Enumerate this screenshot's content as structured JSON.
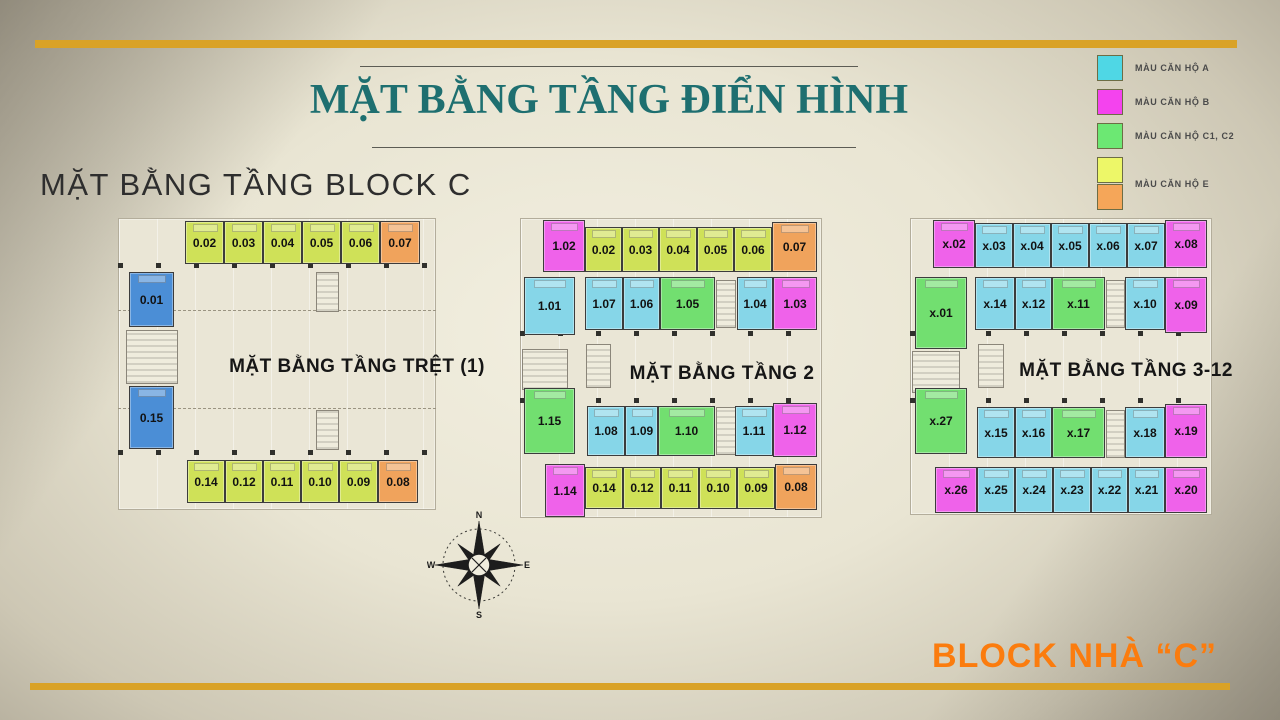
{
  "slide": {
    "title": "MẶT BẰNG TẦNG ĐIỂN HÌNH",
    "subtitle": "MẶT BẰNG TẦNG BLOCK C",
    "footer": "BLOCK NHÀ “C”"
  },
  "compass": {
    "n": "N",
    "e": "E",
    "s": "S",
    "w": "W"
  },
  "legend": {
    "items": [
      {
        "label": "MÀU CĂN HỘ A",
        "colors": [
          "#4fd7e5"
        ]
      },
      {
        "label": "MÀU CĂN HỘ B",
        "colors": [
          "#f443ee"
        ]
      },
      {
        "label": "MÀU CĂN HỘ C1, C2",
        "colors": [
          "#6ce873"
        ]
      },
      {
        "label": "MÀU CĂN HỘ E",
        "colors": [
          "#edf768",
          "#f5a659"
        ]
      }
    ]
  },
  "unit_colors": {
    "A": "#86d6e8",
    "B": "#ef62ea",
    "C": "#72df70",
    "E": "#cfe158",
    "O": "#f0a35c",
    "S": "#4b8ed6"
  },
  "plans": [
    {
      "id": "tret",
      "label": "MẶT BẰNG TẦNG TRỆT (1)",
      "label_cx": 357,
      "label_cy": 367,
      "area": {
        "x": 118,
        "y": 218,
        "w": 318,
        "h": 292
      },
      "structures": [
        {
          "kind": "ticks",
          "x": 118,
          "y": 263,
          "w": 318,
          "h": 5
        },
        {
          "kind": "ticks",
          "x": 118,
          "y": 450,
          "w": 318,
          "h": 5
        },
        {
          "kind": "dash",
          "x": 118,
          "y": 310,
          "w": 318,
          "h": 1
        },
        {
          "kind": "dash",
          "x": 118,
          "y": 408,
          "w": 318,
          "h": 1
        },
        {
          "kind": "core",
          "x": 126,
          "y": 330,
          "w": 52,
          "h": 54
        },
        {
          "kind": "core",
          "x": 316,
          "y": 272,
          "w": 23,
          "h": 40
        },
        {
          "kind": "core",
          "x": 316,
          "y": 410,
          "w": 23,
          "h": 40
        }
      ],
      "units": [
        {
          "id": "0.02",
          "t": "E",
          "x": 185,
          "y": 221,
          "w": 39,
          "h": 43
        },
        {
          "id": "0.03",
          "t": "E",
          "x": 224,
          "y": 221,
          "w": 39,
          "h": 43
        },
        {
          "id": "0.04",
          "t": "E",
          "x": 263,
          "y": 221,
          "w": 39,
          "h": 43
        },
        {
          "id": "0.05",
          "t": "E",
          "x": 302,
          "y": 221,
          "w": 39,
          "h": 43
        },
        {
          "id": "0.06",
          "t": "E",
          "x": 341,
          "y": 221,
          "w": 39,
          "h": 43
        },
        {
          "id": "0.07",
          "t": "O",
          "x": 380,
          "y": 221,
          "w": 40,
          "h": 43
        },
        {
          "id": "0.01",
          "t": "S",
          "x": 129,
          "y": 272,
          "w": 45,
          "h": 55
        },
        {
          "id": "0.15",
          "t": "S",
          "x": 129,
          "y": 386,
          "w": 45,
          "h": 63
        },
        {
          "id": "0.14",
          "t": "E",
          "x": 187,
          "y": 460,
          "w": 38,
          "h": 43
        },
        {
          "id": "0.12",
          "t": "E",
          "x": 225,
          "y": 460,
          "w": 38,
          "h": 43
        },
        {
          "id": "0.11",
          "t": "E",
          "x": 263,
          "y": 460,
          "w": 38,
          "h": 43
        },
        {
          "id": "0.10",
          "t": "E",
          "x": 301,
          "y": 460,
          "w": 38,
          "h": 43
        },
        {
          "id": "0.09",
          "t": "E",
          "x": 339,
          "y": 460,
          "w": 39,
          "h": 43
        },
        {
          "id": "0.08",
          "t": "O",
          "x": 378,
          "y": 460,
          "w": 40,
          "h": 43
        }
      ]
    },
    {
      "id": "tang2",
      "label": "MẶT BẰNG TẦNG 2",
      "label_cx": 722,
      "label_cy": 374,
      "area": {
        "x": 520,
        "y": 218,
        "w": 302,
        "h": 300
      },
      "structures": [
        {
          "kind": "ticks",
          "x": 520,
          "y": 331,
          "w": 300,
          "h": 5
        },
        {
          "kind": "ticks",
          "x": 520,
          "y": 398,
          "w": 300,
          "h": 5
        },
        {
          "kind": "core",
          "x": 716,
          "y": 280,
          "w": 20,
          "h": 48
        },
        {
          "kind": "core",
          "x": 716,
          "y": 407,
          "w": 20,
          "h": 48
        },
        {
          "kind": "core",
          "x": 522,
          "y": 349,
          "w": 46,
          "h": 41
        },
        {
          "kind": "core",
          "x": 586,
          "y": 344,
          "w": 25,
          "h": 44
        }
      ],
      "units": [
        {
          "id": "1.02",
          "t": "B",
          "x": 543,
          "y": 220,
          "w": 42,
          "h": 52
        },
        {
          "id": "0.02",
          "t": "E",
          "x": 585,
          "y": 227,
          "w": 37,
          "h": 45
        },
        {
          "id": "0.03",
          "t": "E",
          "x": 622,
          "y": 227,
          "w": 37,
          "h": 45
        },
        {
          "id": "0.04",
          "t": "E",
          "x": 659,
          "y": 227,
          "w": 38,
          "h": 45
        },
        {
          "id": "0.05",
          "t": "E",
          "x": 697,
          "y": 227,
          "w": 37,
          "h": 45
        },
        {
          "id": "0.06",
          "t": "E",
          "x": 734,
          "y": 227,
          "w": 38,
          "h": 45
        },
        {
          "id": "0.07",
          "t": "O",
          "x": 772,
          "y": 222,
          "w": 45,
          "h": 50
        },
        {
          "id": "1.01",
          "t": "A",
          "x": 524,
          "y": 277,
          "w": 51,
          "h": 58
        },
        {
          "id": "1.07",
          "t": "A",
          "x": 585,
          "y": 277,
          "w": 38,
          "h": 53
        },
        {
          "id": "1.06",
          "t": "A",
          "x": 623,
          "y": 277,
          "w": 37,
          "h": 53
        },
        {
          "id": "1.05",
          "t": "C",
          "x": 660,
          "y": 277,
          "w": 55,
          "h": 53
        },
        {
          "id": "1.04",
          "t": "A",
          "x": 737,
          "y": 277,
          "w": 36,
          "h": 53
        },
        {
          "id": "1.03",
          "t": "B",
          "x": 773,
          "y": 277,
          "w": 44,
          "h": 53
        },
        {
          "id": "1.15",
          "t": "C",
          "x": 524,
          "y": 388,
          "w": 51,
          "h": 66
        },
        {
          "id": "1.08",
          "t": "A",
          "x": 587,
          "y": 406,
          "w": 38,
          "h": 50
        },
        {
          "id": "1.09",
          "t": "A",
          "x": 625,
          "y": 406,
          "w": 33,
          "h": 50
        },
        {
          "id": "1.10",
          "t": "C",
          "x": 658,
          "y": 406,
          "w": 57,
          "h": 50
        },
        {
          "id": "1.11",
          "t": "A",
          "x": 735,
          "y": 406,
          "w": 38,
          "h": 50
        },
        {
          "id": "1.12",
          "t": "B",
          "x": 773,
          "y": 403,
          "w": 44,
          "h": 54
        },
        {
          "id": "1.14",
          "t": "B",
          "x": 545,
          "y": 464,
          "w": 40,
          "h": 53
        },
        {
          "id": "0.14",
          "t": "E",
          "x": 585,
          "y": 467,
          "w": 38,
          "h": 42
        },
        {
          "id": "0.12",
          "t": "E",
          "x": 623,
          "y": 467,
          "w": 38,
          "h": 42
        },
        {
          "id": "0.11",
          "t": "E",
          "x": 661,
          "y": 467,
          "w": 38,
          "h": 42
        },
        {
          "id": "0.10",
          "t": "E",
          "x": 699,
          "y": 467,
          "w": 38,
          "h": 42
        },
        {
          "id": "0.09",
          "t": "E",
          "x": 737,
          "y": 467,
          "w": 38,
          "h": 42
        },
        {
          "id": "0.08",
          "t": "O",
          "x": 775,
          "y": 464,
          "w": 42,
          "h": 46
        }
      ]
    },
    {
      "id": "tang3-12",
      "label": "MẶT BẰNG TẦNG 3-12",
      "label_cx": 1126,
      "label_cy": 371,
      "area": {
        "x": 910,
        "y": 218,
        "w": 302,
        "h": 297
      },
      "structures": [
        {
          "kind": "ticks",
          "x": 910,
          "y": 331,
          "w": 300,
          "h": 5
        },
        {
          "kind": "ticks",
          "x": 910,
          "y": 398,
          "w": 300,
          "h": 5
        },
        {
          "kind": "core",
          "x": 1106,
          "y": 280,
          "w": 19,
          "h": 48
        },
        {
          "kind": "core",
          "x": 1106,
          "y": 410,
          "w": 19,
          "h": 48
        },
        {
          "kind": "core",
          "x": 912,
          "y": 351,
          "w": 48,
          "h": 42
        },
        {
          "kind": "core",
          "x": 978,
          "y": 344,
          "w": 26,
          "h": 44
        }
      ],
      "units": [
        {
          "id": "x.02",
          "t": "B",
          "x": 933,
          "y": 220,
          "w": 42,
          "h": 48
        },
        {
          "id": "x.03",
          "t": "A",
          "x": 975,
          "y": 223,
          "w": 38,
          "h": 45
        },
        {
          "id": "x.04",
          "t": "A",
          "x": 1013,
          "y": 223,
          "w": 38,
          "h": 45
        },
        {
          "id": "x.05",
          "t": "A",
          "x": 1051,
          "y": 223,
          "w": 38,
          "h": 45
        },
        {
          "id": "x.06",
          "t": "A",
          "x": 1089,
          "y": 223,
          "w": 38,
          "h": 45
        },
        {
          "id": "x.07",
          "t": "A",
          "x": 1127,
          "y": 223,
          "w": 38,
          "h": 45
        },
        {
          "id": "x.08",
          "t": "B",
          "x": 1165,
          "y": 220,
          "w": 42,
          "h": 48
        },
        {
          "id": "x.01",
          "t": "C",
          "x": 915,
          "y": 277,
          "w": 52,
          "h": 72
        },
        {
          "id": "x.14",
          "t": "A",
          "x": 975,
          "y": 277,
          "w": 40,
          "h": 53
        },
        {
          "id": "x.12",
          "t": "A",
          "x": 1015,
          "y": 277,
          "w": 37,
          "h": 53
        },
        {
          "id": "x.11",
          "t": "C",
          "x": 1052,
          "y": 277,
          "w": 53,
          "h": 53
        },
        {
          "id": "x.10",
          "t": "A",
          "x": 1125,
          "y": 277,
          "w": 40,
          "h": 53
        },
        {
          "id": "x.09",
          "t": "B",
          "x": 1165,
          "y": 277,
          "w": 42,
          "h": 56
        },
        {
          "id": "x.27",
          "t": "C",
          "x": 915,
          "y": 388,
          "w": 52,
          "h": 66
        },
        {
          "id": "x.15",
          "t": "A",
          "x": 977,
          "y": 407,
          "w": 38,
          "h": 51
        },
        {
          "id": "x.16",
          "t": "A",
          "x": 1015,
          "y": 407,
          "w": 37,
          "h": 51
        },
        {
          "id": "x.17",
          "t": "C",
          "x": 1052,
          "y": 407,
          "w": 53,
          "h": 51
        },
        {
          "id": "x.18",
          "t": "A",
          "x": 1125,
          "y": 407,
          "w": 40,
          "h": 51
        },
        {
          "id": "x.19",
          "t": "B",
          "x": 1165,
          "y": 404,
          "w": 42,
          "h": 54
        },
        {
          "id": "x.26",
          "t": "B",
          "x": 935,
          "y": 467,
          "w": 42,
          "h": 46
        },
        {
          "id": "x.25",
          "t": "A",
          "x": 977,
          "y": 467,
          "w": 38,
          "h": 46
        },
        {
          "id": "x.24",
          "t": "A",
          "x": 1015,
          "y": 467,
          "w": 38,
          "h": 46
        },
        {
          "id": "x.23",
          "t": "A",
          "x": 1053,
          "y": 467,
          "w": 38,
          "h": 46
        },
        {
          "id": "x.22",
          "t": "A",
          "x": 1091,
          "y": 467,
          "w": 37,
          "h": 46
        },
        {
          "id": "x.21",
          "t": "A",
          "x": 1128,
          "y": 467,
          "w": 37,
          "h": 46
        },
        {
          "id": "x.20",
          "t": "B",
          "x": 1165,
          "y": 467,
          "w": 42,
          "h": 46
        }
      ]
    }
  ]
}
